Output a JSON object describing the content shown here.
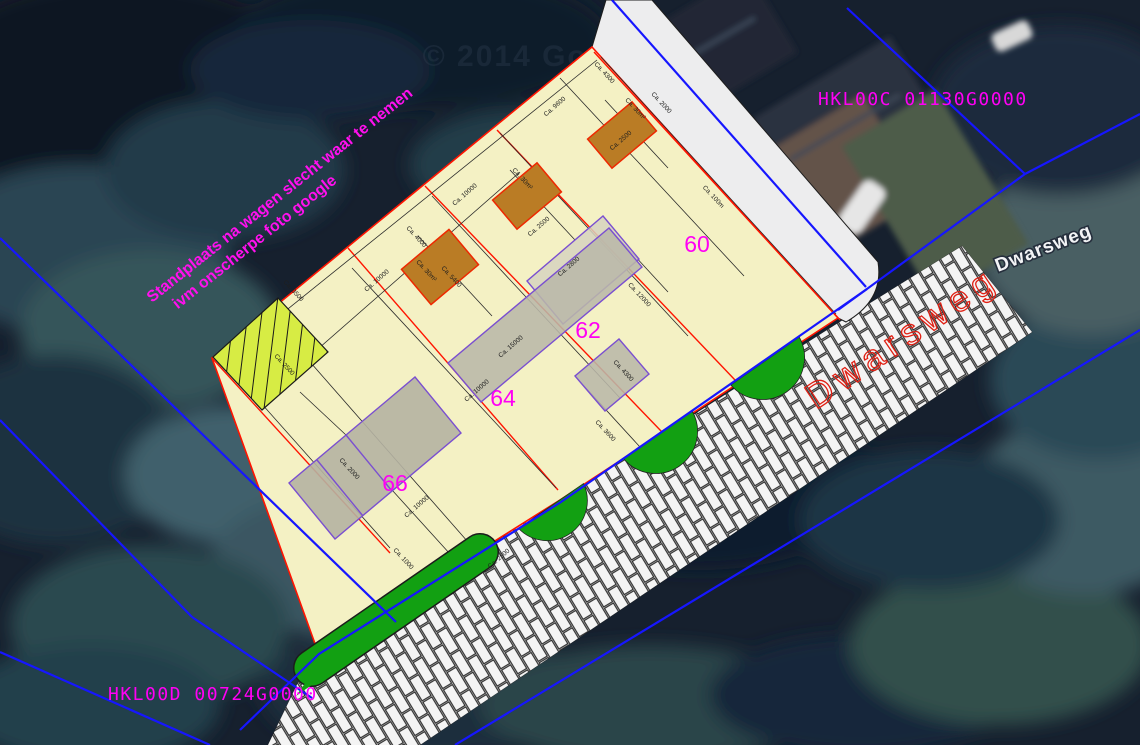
{
  "map_overlay": {
    "annotation": {
      "line1": "Standplaats na wagen slecht waar te nemen",
      "line2": "ivm onscherpe foto google"
    },
    "cadastral_labels": {
      "top_right": "HKL00C 01130G0000",
      "bottom_left": "HKL00D 00724G0000"
    },
    "street_labels": {
      "osm": "Dwarsweg",
      "cad": "Dwarsweg"
    },
    "watermark": "© 2014 Google",
    "parcel_numbers": [
      {
        "id": "60",
        "x": 697,
        "y": 252
      },
      {
        "id": "62",
        "x": 588,
        "y": 338
      },
      {
        "id": "64",
        "x": 503,
        "y": 406
      },
      {
        "id": "66",
        "x": 395,
        "y": 491
      }
    ],
    "dimension_labels": [
      {
        "t": "Ca. 9600",
        "x": 556,
        "y": 108,
        "r": -41
      },
      {
        "t": "Ca. 4300",
        "x": 603,
        "y": 74,
        "r": 47
      },
      {
        "t": "Ca. 2000",
        "x": 660,
        "y": 104,
        "r": 47
      },
      {
        "t": "Ca. 30m²",
        "x": 634,
        "y": 110,
        "r": 47
      },
      {
        "t": "Ca. 2500",
        "x": 622,
        "y": 142,
        "r": -41
      },
      {
        "t": "Ca. 100m",
        "x": 712,
        "y": 198,
        "r": 47
      },
      {
        "t": "Ca. 10000",
        "x": 466,
        "y": 196,
        "r": -41
      },
      {
        "t": "Ca. 30m²",
        "x": 521,
        "y": 180,
        "r": 47
      },
      {
        "t": "Ca. 2500",
        "x": 540,
        "y": 228,
        "r": -41
      },
      {
        "t": "Ca. 4000",
        "x": 415,
        "y": 238,
        "r": 47
      },
      {
        "t": "Ca. 10000",
        "x": 378,
        "y": 282,
        "r": -41
      },
      {
        "t": "Ca. 30m²",
        "x": 425,
        "y": 272,
        "r": 47
      },
      {
        "t": "Ca. 5400",
        "x": 450,
        "y": 278,
        "r": 47
      },
      {
        "t": "Ca. 2800",
        "x": 570,
        "y": 268,
        "r": -41
      },
      {
        "t": "Ca. 12000",
        "x": 638,
        "y": 296,
        "r": 47
      },
      {
        "t": "Ca. 15000",
        "x": 512,
        "y": 348,
        "r": -41
      },
      {
        "t": "Ca. 10000",
        "x": 478,
        "y": 392,
        "r": -41
      },
      {
        "t": "Ca. 4300",
        "x": 622,
        "y": 372,
        "r": 47
      },
      {
        "t": "Ca. 3600",
        "x": 604,
        "y": 432,
        "r": 47
      },
      {
        "t": "Ca. 3500",
        "x": 292,
        "y": 292,
        "r": 47
      },
      {
        "t": "Ca. 2500",
        "x": 283,
        "y": 366,
        "r": 47
      },
      {
        "t": "Ca. 2000",
        "x": 348,
        "y": 470,
        "r": 47
      },
      {
        "t": "Ca. 1000",
        "x": 402,
        "y": 560,
        "r": 47
      },
      {
        "t": "Ca. 2500",
        "x": 500,
        "y": 560,
        "r": -41
      },
      {
        "t": "Ca. 10000",
        "x": 418,
        "y": 508,
        "r": -41
      }
    ],
    "colors": {
      "parcel_fill": "#f4f1c4",
      "parcel_border": "#ff1400",
      "proposed_building": "#ba7c25",
      "proposed_building_border": "#ee2800",
      "existing_building": "#b9b7a8",
      "existing_building_border": "#7a4fd0",
      "hatch_fill": "#d7ec44",
      "green_verge": "#12a012",
      "cadastral_line": "#1616ff",
      "magenta": "#ff00f5",
      "road_label_red": "#e02014",
      "sidewalk": "#ededee"
    }
  }
}
